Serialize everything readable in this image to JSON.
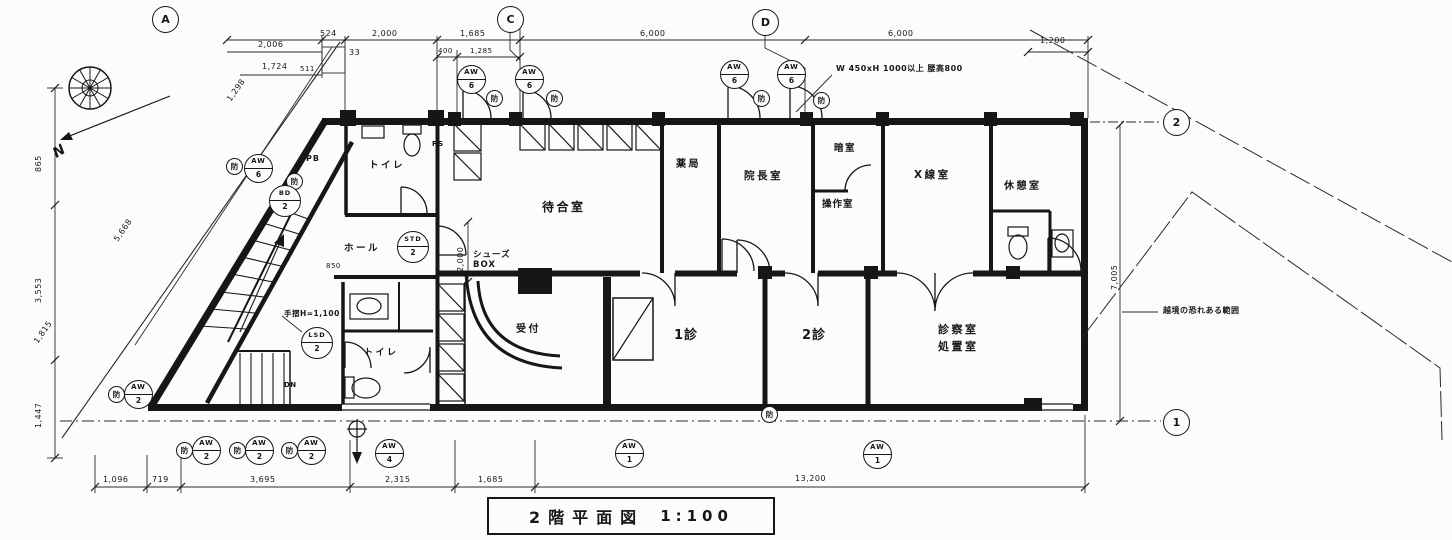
{
  "title": {
    "main": "2階平面図",
    "scale": "1:100"
  },
  "grid": {
    "a": "A",
    "c": "C",
    "d": "D",
    "r1": "1",
    "r2": "2"
  },
  "compass": {
    "n": "N"
  },
  "rooms": {
    "toilet_upper": "トイレ",
    "toilet_lower": "トイレ",
    "pb": "PB",
    "ps": "PS",
    "hall": "ホール",
    "waiting": "待合室",
    "shoes1": "シューズ",
    "shoes2": "BOX",
    "reception": "受付",
    "pharmacy": "薬局",
    "director": "院長室",
    "darkroom": "暗室",
    "control": "操作室",
    "xray": "X線室",
    "rest": "休憩室",
    "exam1": "1診",
    "exam2": "2診",
    "treat1": "診察室",
    "treat2": "処置室"
  },
  "notes": {
    "window_spec": "W 450xH 1000以上 腰高800",
    "handrail": "手摺H=1,100",
    "down": "DN",
    "boundary": "越境の恐れある範囲"
  },
  "dims": {
    "top": {
      "a2006": "2,006",
      "a1724": "1,724",
      "a511": "511",
      "a524": "524",
      "a33": "33",
      "a2000": "2,000",
      "a1685": "1,685",
      "a400": "400",
      "a1285": "1,285",
      "a6000a": "6,000",
      "a6000b": "6,000",
      "a1200": "1,200"
    },
    "left": {
      "a865": "865",
      "a3553": "3,553",
      "a1447": "1,447",
      "a5668": "5,668",
      "a1815": "1,815",
      "a1298": "1,298"
    },
    "right": {
      "a7005": "7,005"
    },
    "inner": {
      "v2000": "2,000",
      "a850": "850"
    },
    "bottom": {
      "a1096": "1,096",
      "a719": "719",
      "a3695": "3,695",
      "a2315": "2,315",
      "b1685": "1,685",
      "a13200": "13,200"
    }
  },
  "marks": {
    "aw": "AW",
    "bo": "防",
    "bd": "BD",
    "bd_num": "2",
    "std": "STD",
    "std_num": "2",
    "lsd": "LSD",
    "lsd_num": "2",
    "nums": {
      "t1": "6",
      "t2": "6",
      "t3": "6",
      "t4": "6",
      "left": "6",
      "sw": "2",
      "b1": "2",
      "b2": "2",
      "b3": "2",
      "entry": "4",
      "long1": "1",
      "long2": "1"
    }
  }
}
